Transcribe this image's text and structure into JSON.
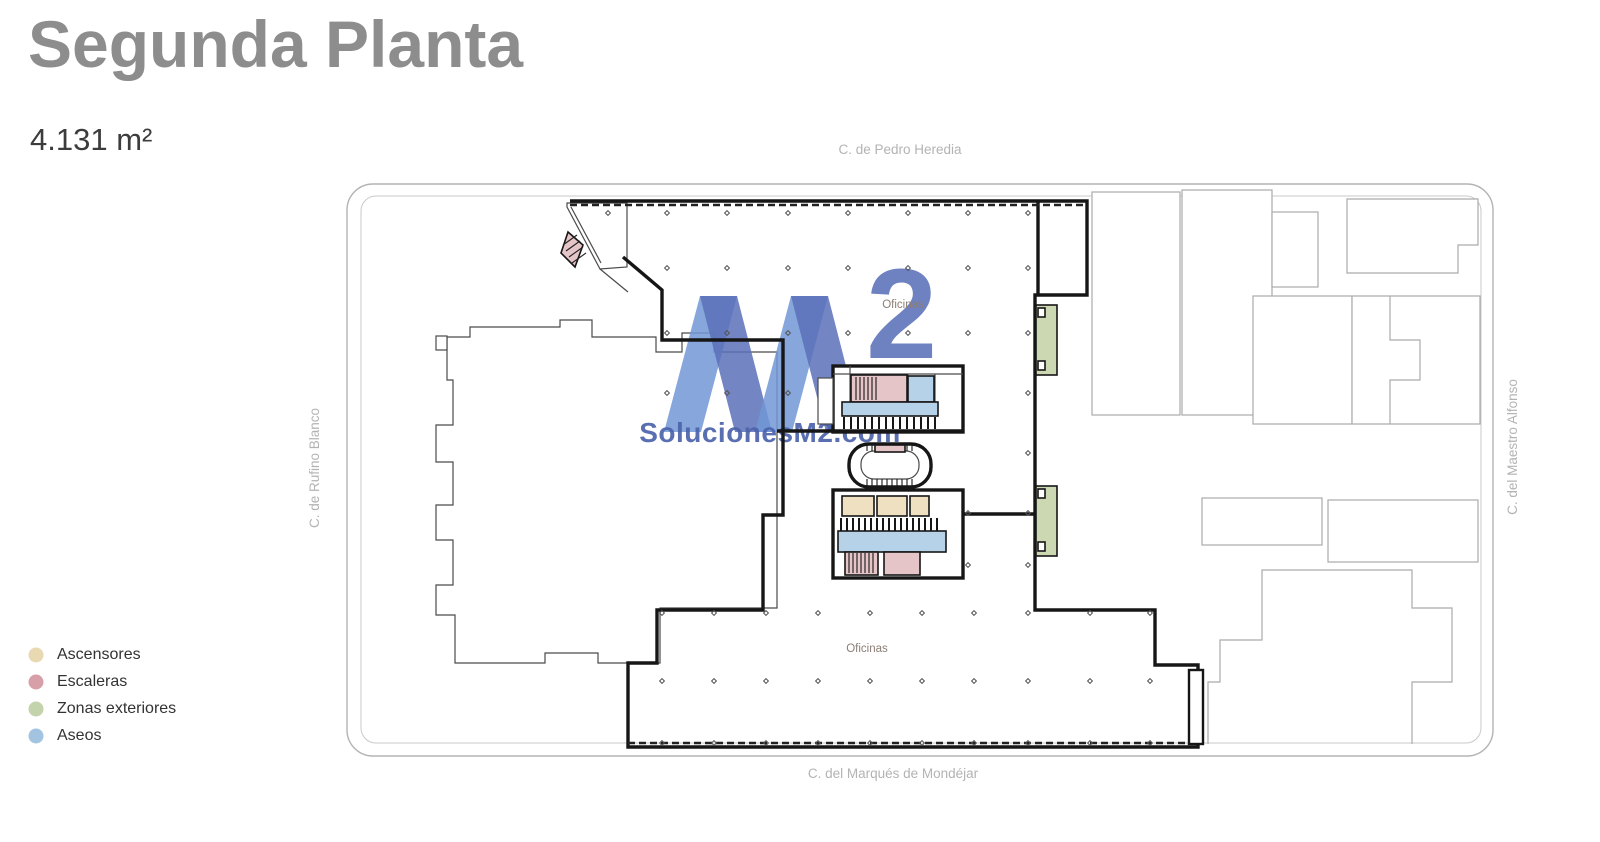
{
  "header": {
    "title": "Segunda Planta",
    "area": "4.131 m²"
  },
  "streets": {
    "top": "C. de Pedro Heredia",
    "bottom": "C. del Marqués de Mondéjar",
    "left": "C. de Rufino Blanco",
    "right": "C. del Maestro Alfonso"
  },
  "plan": {
    "oficinas_top": "Oficinas",
    "oficinas_bottom": "Oficinas",
    "column_grid": {
      "rows": [
        {
          "y": 213,
          "xs": [
            608,
            667,
            727,
            788,
            848,
            908,
            968,
            1028
          ]
        },
        {
          "y": 268,
          "xs": [
            667,
            727,
            788,
            848,
            908,
            968,
            1028
          ]
        },
        {
          "y": 333,
          "xs": [
            667,
            727,
            788,
            848,
            908,
            968,
            1028
          ]
        },
        {
          "y": 393,
          "xs": [
            667,
            727,
            788,
            1028
          ]
        },
        {
          "y": 453,
          "xs": [
            1028
          ]
        },
        {
          "y": 513,
          "xs": [
            968,
            1028
          ]
        },
        {
          "y": 565,
          "xs": [
            968,
            1028
          ]
        },
        {
          "y": 613,
          "xs": [
            662,
            714,
            766,
            818,
            870,
            922,
            974,
            1028,
            1090,
            1150
          ]
        },
        {
          "y": 681,
          "xs": [
            662,
            714,
            766,
            818,
            870,
            922,
            974,
            1028,
            1090,
            1150
          ]
        },
        {
          "y": 743,
          "xs": [
            662,
            714,
            766,
            818,
            870,
            922,
            974,
            1028,
            1090,
            1150
          ]
        }
      ]
    }
  },
  "watermark": {
    "sup": "2",
    "site": "SolucionesM2.com"
  },
  "legend": {
    "items": [
      {
        "label": "Ascensores",
        "color": "#e9d9b2"
      },
      {
        "label": "Escaleras",
        "color": "#d7a0a8"
      },
      {
        "label": "Zonas exteriores",
        "color": "#c3d3ab"
      },
      {
        "label": "Aseos",
        "color": "#a3c4e0"
      }
    ]
  },
  "colors": {
    "title_gray": "#8d8d8d",
    "escaleras_room": "#e6c5c8",
    "ascensores_room": "#eee0c0",
    "aseos_room": "#b5d2e8",
    "zonas_room": "#cbd8b2",
    "wm_light": "#7196d6",
    "wm_dark": "#5b70b9",
    "wm_text": "#4c63ab"
  }
}
